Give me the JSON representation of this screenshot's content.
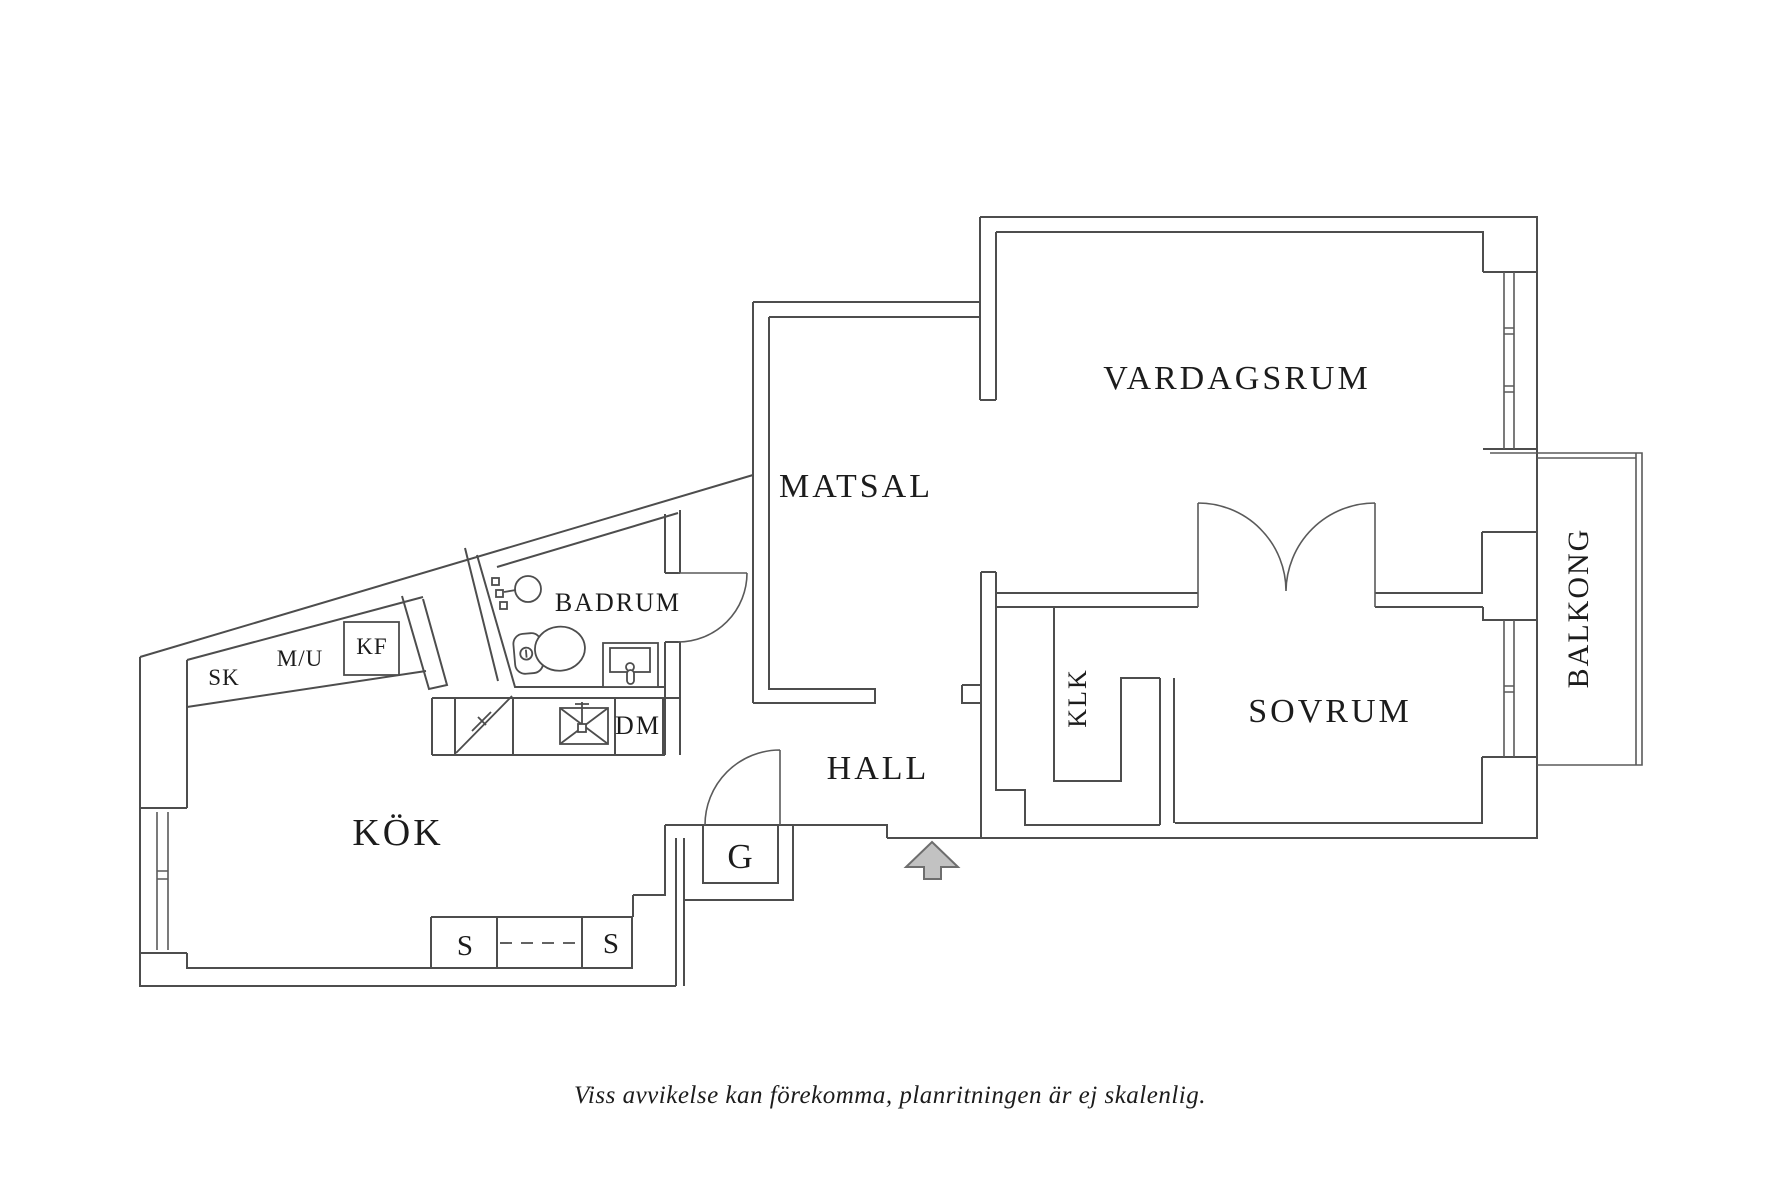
{
  "colors": {
    "background": "#ffffff",
    "line": "#4d4d4d",
    "text": "#1c1c1c",
    "arrow_fill": "#c2c2c2",
    "arrow_stroke": "#6e6e6e"
  },
  "rooms": {
    "vardagsrum": "VARDAGSRUM",
    "matsal": "MATSAL",
    "badrum": "BADRUM",
    "kok": "KÖK",
    "hall": "HALL",
    "sovrum": "SOVRUM",
    "klk": "KLK",
    "balkong": "BALKONG"
  },
  "labels": {
    "sk": "SK",
    "mu": "M/U",
    "kf": "KF",
    "dm": "DM",
    "g": "G",
    "s_left": "S",
    "s_right": "S"
  },
  "caption": "Viss avvikelse kan förekomma, planritningen är ej skalenlig."
}
